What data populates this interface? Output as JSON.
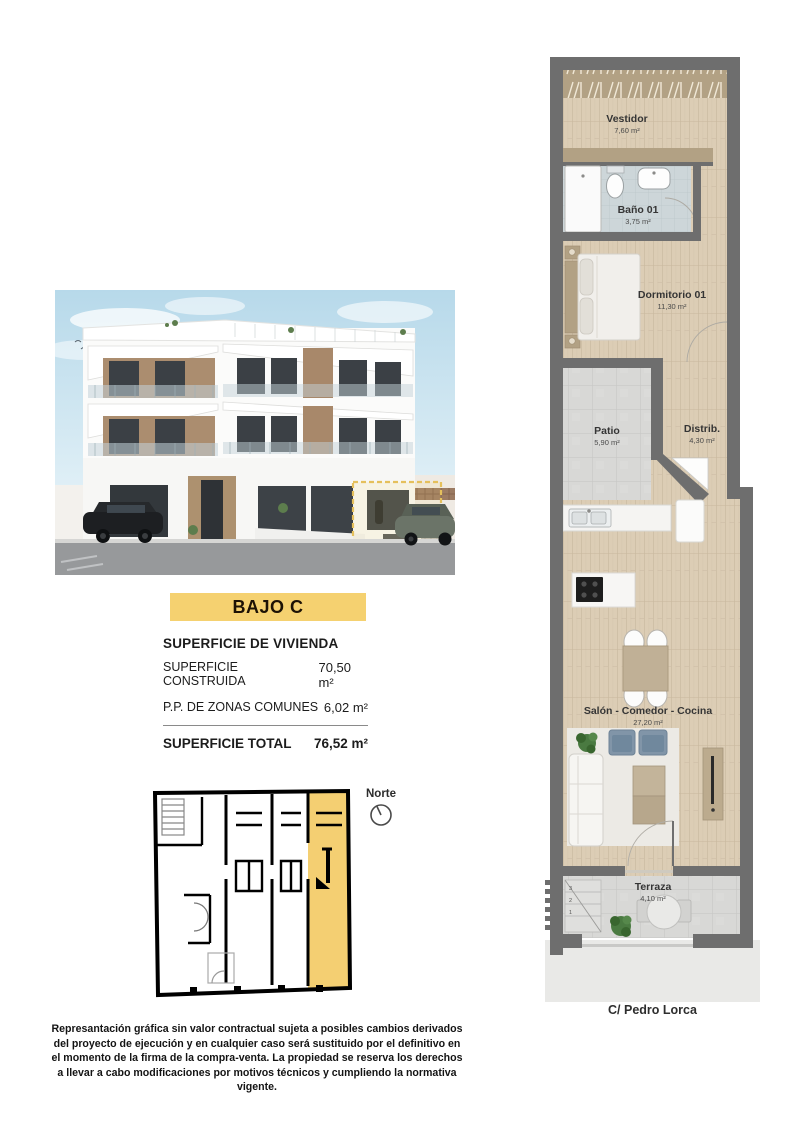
{
  "page": {
    "background": "#ffffff"
  },
  "unit": {
    "label": "BAJO C",
    "accent_color": "#F5D170"
  },
  "surface_table": {
    "section_title": "SUPERFICIE DE VIVIENDA",
    "rows": [
      {
        "label": "SUPERFICIE CONSTRUIDA",
        "value": "70,50 m²"
      },
      {
        "label": "P.P. DE ZONAS COMUNES",
        "value": "6,02 m²"
      }
    ],
    "total_label": "SUPERFICIE TOTAL",
    "total_value": "76,52 m²"
  },
  "floor_plan": {
    "rooms": [
      {
        "name": "Vestidor",
        "area": "7,60 m²"
      },
      {
        "name": "Baño 01",
        "area": "3,75 m²"
      },
      {
        "name": "Dormitorio 01",
        "area": "11,30 m²"
      },
      {
        "name": "Patio",
        "area": "5,90 m²"
      },
      {
        "name": "Distrib.",
        "area": "4,30 m²"
      },
      {
        "name": "Salón - Comedor - Cocina",
        "area": "27,20 m²"
      },
      {
        "name": "Terraza",
        "area": "4,10 m²"
      }
    ],
    "step_labels": [
      "3",
      "2",
      "1"
    ],
    "street": "C/ Pedro Lorca",
    "wall_color": "#6e6e6e",
    "wood_color": "#dccdb5",
    "tile_color": "#d8d8d6",
    "bath_tile_color": "#cdd6d9"
  },
  "key_plan": {
    "north_label": "Norte",
    "highlight_color": "#F4CF72"
  },
  "disclaimer": "Represantación gráfica sin valor contractual sujeta a posibles cambios derivados del proyecto de ejecución y en cualquier caso será sustituido por el definitivo en el momento de la firma de la compra-venta. La propiedad se reserva los derechos a llevar a cabo modificaciones por motivos técnicos y cumpliendo la normativa vigente."
}
